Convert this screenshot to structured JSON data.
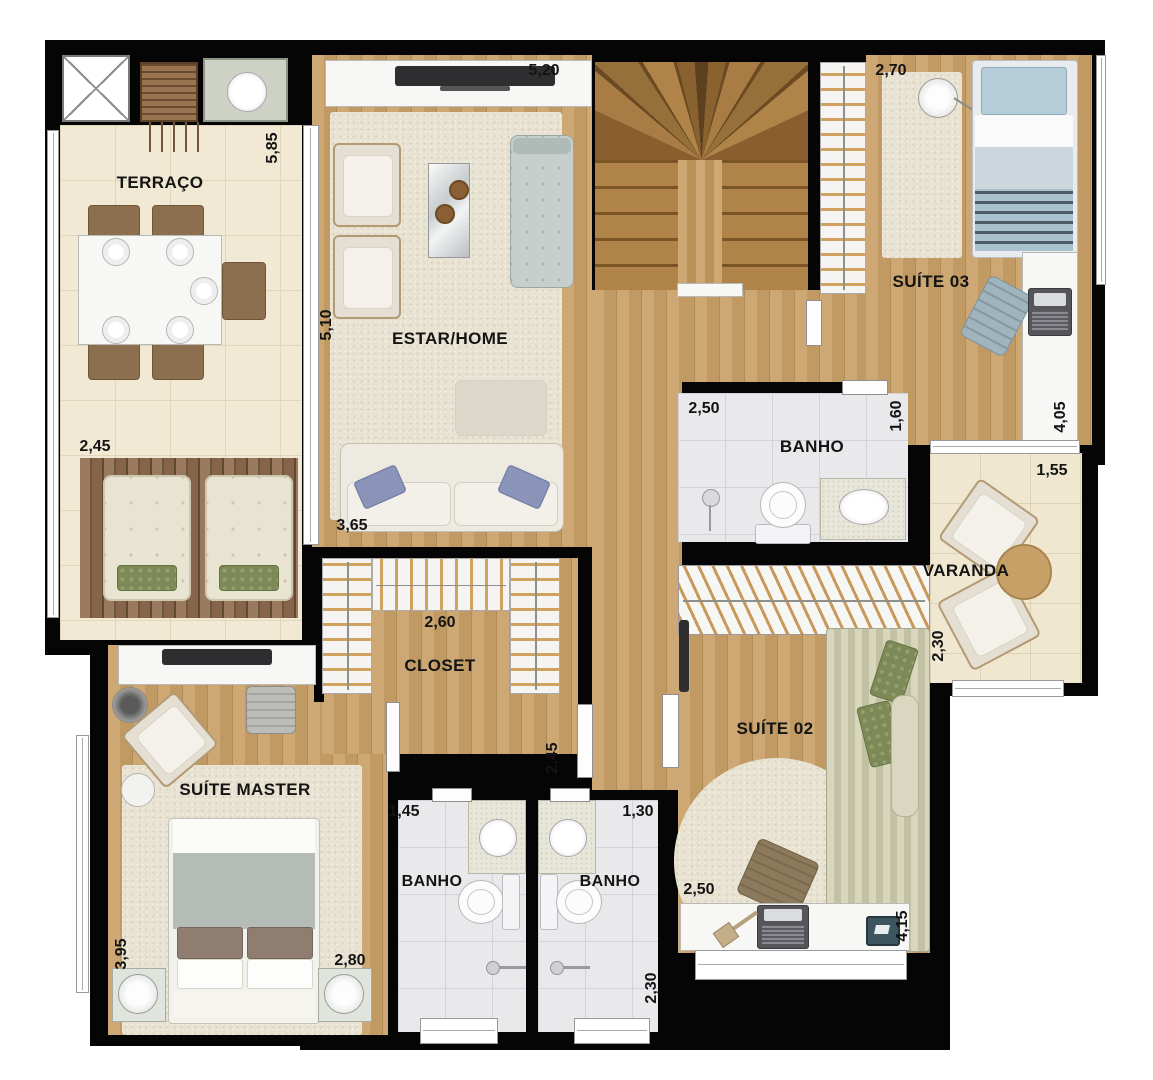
{
  "plan_type": "apartment-floor-plan",
  "rooms": [
    {
      "key": "terraco",
      "label": "TERRAÇO",
      "dims": [
        "5,85",
        "2,45"
      ]
    },
    {
      "key": "estar-home",
      "label": "ESTAR/HOME",
      "dims": [
        "5,20",
        "5,10",
        "3,65"
      ]
    },
    {
      "key": "suite-03",
      "label": "SUÍTE 03",
      "dims": [
        "2,70",
        "4,05"
      ]
    },
    {
      "key": "banho-social",
      "label": "BANHO",
      "dims": [
        "2,50",
        "1,60"
      ]
    },
    {
      "key": "varanda",
      "label": "VARANDA",
      "dims": [
        "1,55",
        "2,30"
      ]
    },
    {
      "key": "closet",
      "label": "CLOSET",
      "dims": [
        "2,60",
        "2,45"
      ]
    },
    {
      "key": "suite-master",
      "label": "SUÍTE MASTER",
      "dims": [
        "3,95",
        "2,80"
      ]
    },
    {
      "key": "banho-master",
      "label": "BANHO",
      "dims": [
        "1,45"
      ]
    },
    {
      "key": "banho-suite02",
      "label": "BANHO",
      "dims": [
        "1,30",
        "2,30"
      ]
    },
    {
      "key": "suite-02",
      "label": "SUÍTE 02",
      "dims": [
        "2,50",
        "4,15"
      ]
    }
  ],
  "furniture": {
    "terraco": [
      "elevator-shaft",
      "barbecue-grill",
      "sink-counter",
      "dining-table",
      "dining-chairs",
      "wood-deck",
      "sun-loungers"
    ],
    "estar-home": [
      "tv-console",
      "tv",
      "armchairs",
      "mirror-coffee-table",
      "chaise",
      "ottoman",
      "sofa",
      "rug"
    ],
    "stairs": [
      "u-shaped-staircase",
      "bookshelf"
    ],
    "suite-03": [
      "single-bed",
      "rug",
      "floor-lamp",
      "desk",
      "laptop",
      "chair"
    ],
    "banho-social": [
      "toilet",
      "sink-counter",
      "shower"
    ],
    "varanda": [
      "armchairs",
      "round-table"
    ],
    "closet": [
      "u-shaped-wardrobe"
    ],
    "suite-master": [
      "tv-console",
      "tv",
      "armchair",
      "desk-chair",
      "floor-lamp",
      "side-table",
      "double-bed",
      "nightstands",
      "lamps",
      "rug"
    ],
    "banho-master": [
      "sink-counter",
      "toilet",
      "shower-bar"
    ],
    "banho-suite02": [
      "sink-counter",
      "toilet",
      "shower-bar"
    ],
    "suite-02": [
      "wardrobe",
      "wall-tv",
      "single-bed",
      "round-rug",
      "desk",
      "laptop",
      "desk-lamp",
      "chair",
      "tablet"
    ]
  },
  "colors": {
    "wall": "#050505",
    "wood_floor": "#c5a069",
    "stair_wood": "#a87c44",
    "terrace_tile": "#f1e9d3",
    "deck_wood": "#86644a",
    "bath_tile": "#e9e9ec",
    "rug": "#e8e2d2",
    "pillow_blue": "#8a93b8",
    "pillow_green": "#7d8a57",
    "bed_blue": "#b5cdd9"
  }
}
